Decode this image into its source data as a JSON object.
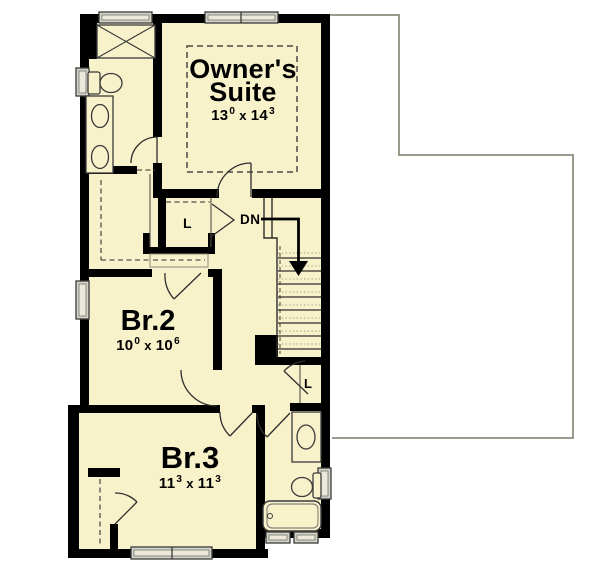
{
  "plan": {
    "rooms": {
      "owner_suite": {
        "name_line1": "Owner's",
        "name_line2": "Suite",
        "dim_w": "13",
        "dim_w_sup": "0",
        "dim_sep": "x",
        "dim_h": "14",
        "dim_h_sup": "3"
      },
      "br2": {
        "name": "Br.2",
        "dim_w": "10",
        "dim_w_sup": "0",
        "dim_sep": "x",
        "dim_h": "10",
        "dim_h_sup": "6"
      },
      "br3": {
        "name": "Br.3",
        "dim_w": "11",
        "dim_w_sup": "3",
        "dim_sep": "x",
        "dim_h": "11",
        "dim_h_sup": "3"
      }
    },
    "labels": {
      "stairs_down": "DN",
      "linen_upper": "L",
      "linen_lower": "L"
    },
    "colors": {
      "floor": "#f8f2cb",
      "wall": "#000000",
      "window_fill": "#d2d2c8",
      "window_inner": "#ece9dc",
      "roof_outline": "#8f8e7e",
      "dashed_line": "#55534a",
      "door_line": "#2e2e2e"
    }
  }
}
